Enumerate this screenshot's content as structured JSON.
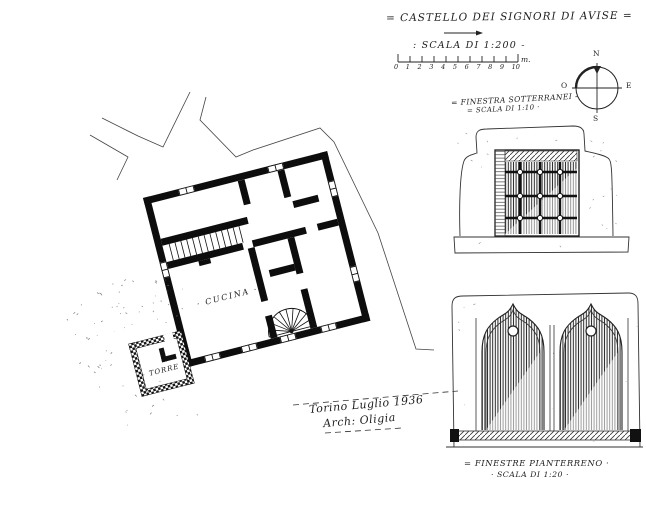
{
  "drawing": {
    "title": "= CASTELLO DEI SIGNORI DI AVISE =",
    "main_scale": ": SCALA DI 1:200 -",
    "scale_bar": {
      "ticks": [
        "0",
        "1",
        "2",
        "3",
        "4",
        "5",
        "6",
        "7",
        "8",
        "9",
        "10"
      ],
      "unit": "m."
    },
    "compass": {
      "north": "N",
      "east": "E",
      "south": "S",
      "west": "O"
    },
    "plan": {
      "kitchen_label": "· CUCINA ·",
      "tower_label": "· TORRE ·"
    },
    "detail_basement": {
      "caption": "= FINESTRA SOTTERRANEI -",
      "scale_note": "= SCALA DI 1:10 ·"
    },
    "detail_ground_floor": {
      "caption": "= FINESTRE PIANTERRENO ·",
      "scale_note": "· SCALA DI 1:20 ·"
    },
    "signature": {
      "place_date": "Torino Luglio 1936",
      "author": "Arch: Oligia"
    }
  }
}
